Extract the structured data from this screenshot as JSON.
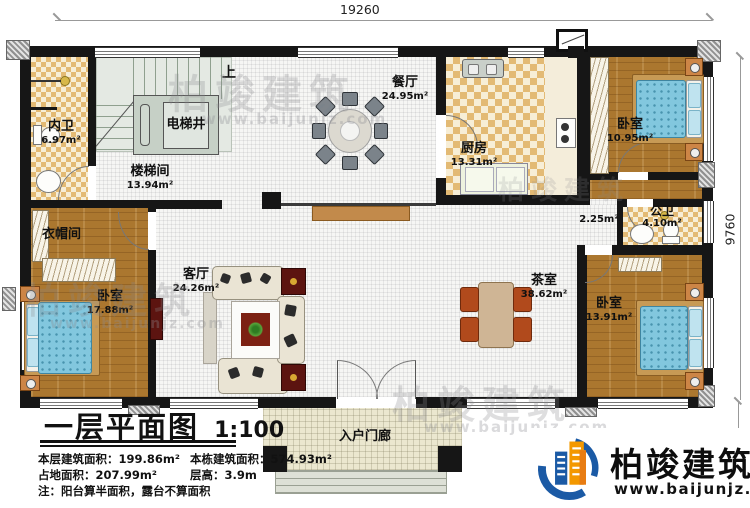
{
  "dimensions": {
    "top": "19260",
    "right": "9760",
    "porch": "1600"
  },
  "rooms": {
    "neiwei": {
      "name": "内卫",
      "area": "6.97m²"
    },
    "diantijing": {
      "name": "电梯井"
    },
    "loutijian": {
      "name": "楼梯间",
      "area": "13.94m²"
    },
    "shang": "上",
    "canting": {
      "name": "餐厅",
      "area": "24.95m²"
    },
    "chufang": {
      "name": "厨房",
      "area": "13.31m²"
    },
    "woshi_top_right": {
      "name": "卧室",
      "area": "10.95m²"
    },
    "gongwei": {
      "name": "公卫",
      "area": "4.10m²"
    },
    "guodao": {
      "area": "2.25m²"
    },
    "yimaojian": {
      "name": "衣帽间"
    },
    "woshi_left": {
      "name": "卧室",
      "area": "17.88m²"
    },
    "keting": {
      "name": "客厅",
      "area": "24.26m²"
    },
    "chashi": {
      "name": "茶室",
      "area": "38.62m²"
    },
    "woshi_bottom_right": {
      "name": "卧室",
      "area": "13.91m²"
    },
    "rumenlang": {
      "name": "入户门廊"
    }
  },
  "title_block": {
    "title": "一层平面图",
    "scale": "1:100",
    "line1a": "本层建筑面积：199.86m²",
    "line1b": "本栋建筑面积：574.93m²",
    "line2a": "占地面积：207.99m²",
    "line2b": "层高：3.9m",
    "note": "注：阳台算半面积，露台不算面积"
  },
  "logo": {
    "name": "柏竣建筑",
    "website": "www.baijunjz.com"
  },
  "watermark": {
    "text": "柏竣建筑",
    "url": "www.baijunjz.com"
  },
  "colors": {
    "logo_blue": "#1b5aa5",
    "logo_orange": "#f39800",
    "wall": "#161616",
    "wood_floor": "#ab772f",
    "checker_tan": "#e3ba74",
    "bed_blue": "#82c7de"
  }
}
